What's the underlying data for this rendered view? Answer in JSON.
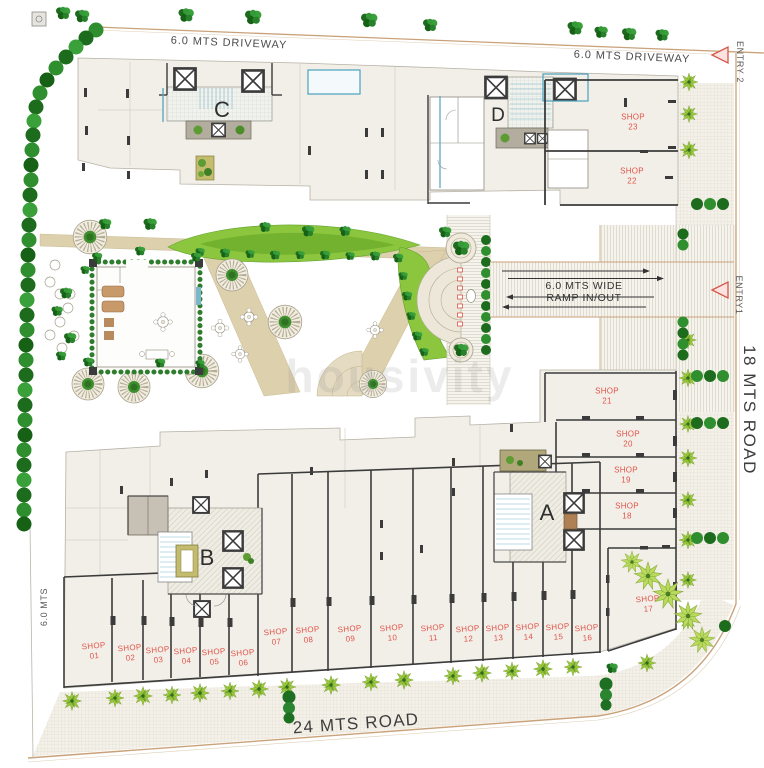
{
  "meta": {
    "description": "Residential project ground-floor site plan"
  },
  "roads": {
    "driveway_top_left": "6.0 MTS DRIVEWAY",
    "driveway_top_right": "6.0 MTS DRIVEWAY",
    "road_right": "18 MTS ROAD",
    "road_bottom": "24 MTS ROAD",
    "left_margin": "6.0 MTS"
  },
  "entries": {
    "entry1": "ENTRY1",
    "entry2": "ENTRY 2"
  },
  "ramp": {
    "line1": "6.0 MTS WIDE",
    "line2": "RAMP IN/OUT"
  },
  "buildings": {
    "a": "A",
    "b": "B",
    "c": "C",
    "d": "D"
  },
  "shops": {
    "prefix": "SHOP",
    "numbers": [
      "01",
      "02",
      "03",
      "04",
      "05",
      "06",
      "07",
      "08",
      "09",
      "10",
      "11",
      "12",
      "13",
      "14",
      "15",
      "16",
      "17",
      "18",
      "19",
      "20",
      "21",
      "22",
      "23"
    ]
  },
  "watermark": "housivity",
  "colors": {
    "shop_label": "#e0544a",
    "entry_marker": "#d85548",
    "wall": "#3b3b3b",
    "road_line": "#c9a27a",
    "lawn": "#8cc63e",
    "accent_blue": "#5fa8c0",
    "plate": "#f2efe8"
  }
}
